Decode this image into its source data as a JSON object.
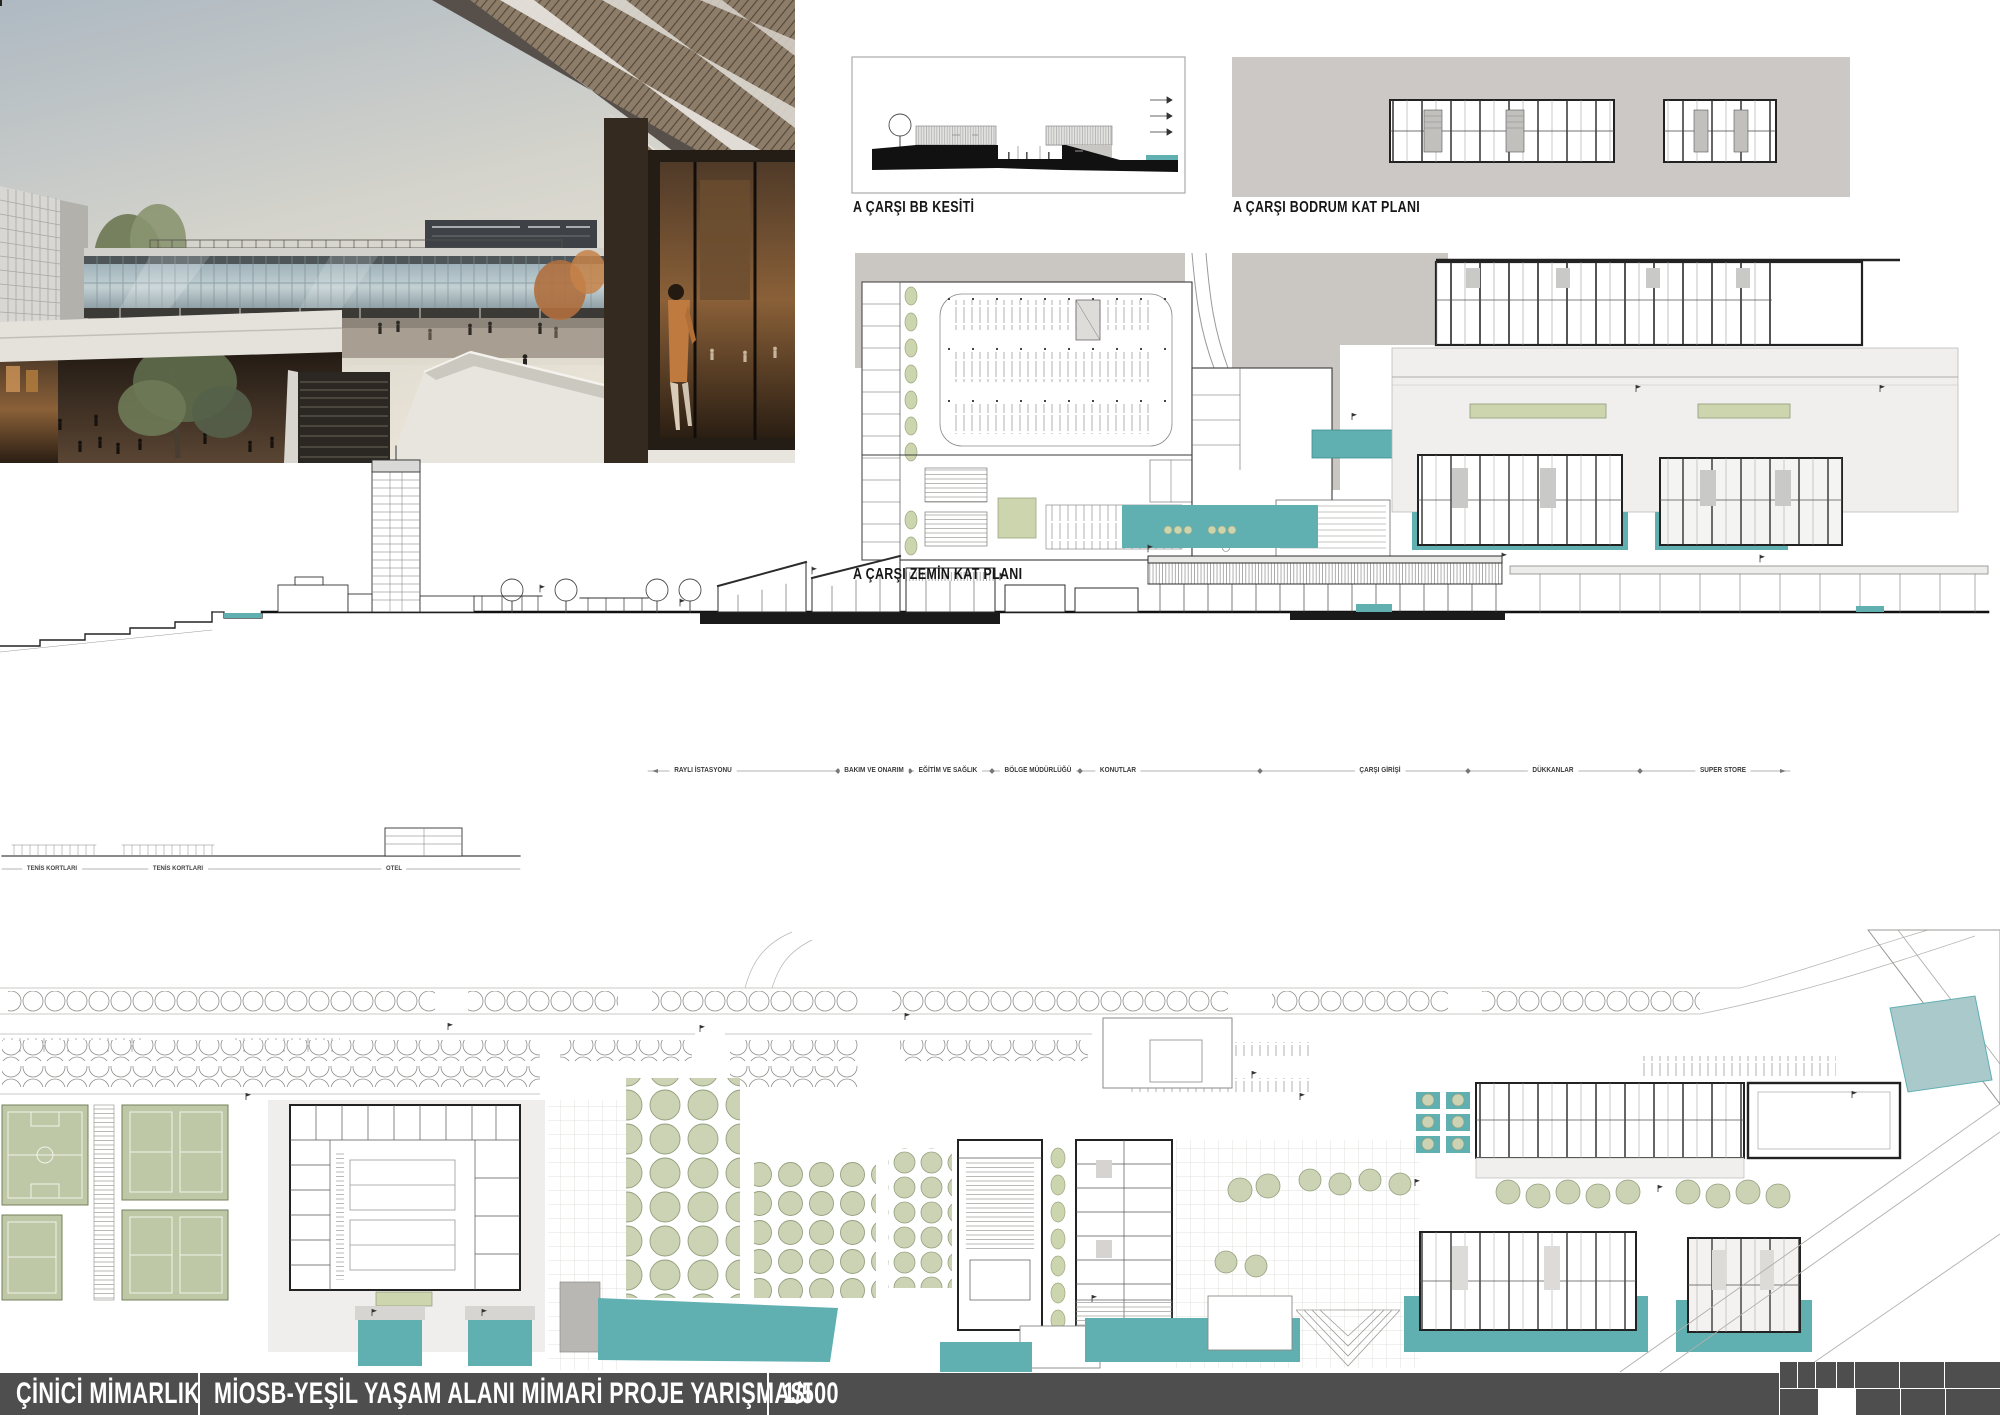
{
  "title_bar": {
    "firm": "ÇİNİCİ MİMARLIK",
    "project": "MİOSB-YEŞİL YAŞAM ALANI MİMARİ PROJE YARIŞMASI",
    "scale": "1/500"
  },
  "drawing_labels": {
    "section_bb": "A ÇARŞI BB KESİTİ",
    "basement_plan": "A ÇARŞI BODRUM KAT PLANI",
    "ground_plan": "A ÇARŞI ZEMİN KAT PLANI"
  },
  "site_section_labels": [
    "RAYLI İSTASYONU",
    "BAKIM VE ONARIM",
    "EĞİTİM VE SAĞLIK",
    "BÖLGE MÜDÜRLÜĞÜ",
    "KONUTLAR",
    "ÇARŞI GİRİŞİ",
    "DÜKKANLAR",
    "SUPER STORE"
  ],
  "left_section_labels": [
    "TENİS KORTLARI",
    "TENİS KORTLARI",
    "OTEL"
  ],
  "colors": {
    "teal_water": "#60afb1",
    "teal_light": "#a9c9cb",
    "sage_tree": "#ccd3b4",
    "olive_court": "#bfc8a6",
    "taupe_ground": "#cac7c2",
    "title_bar": "#4e4e4e"
  }
}
